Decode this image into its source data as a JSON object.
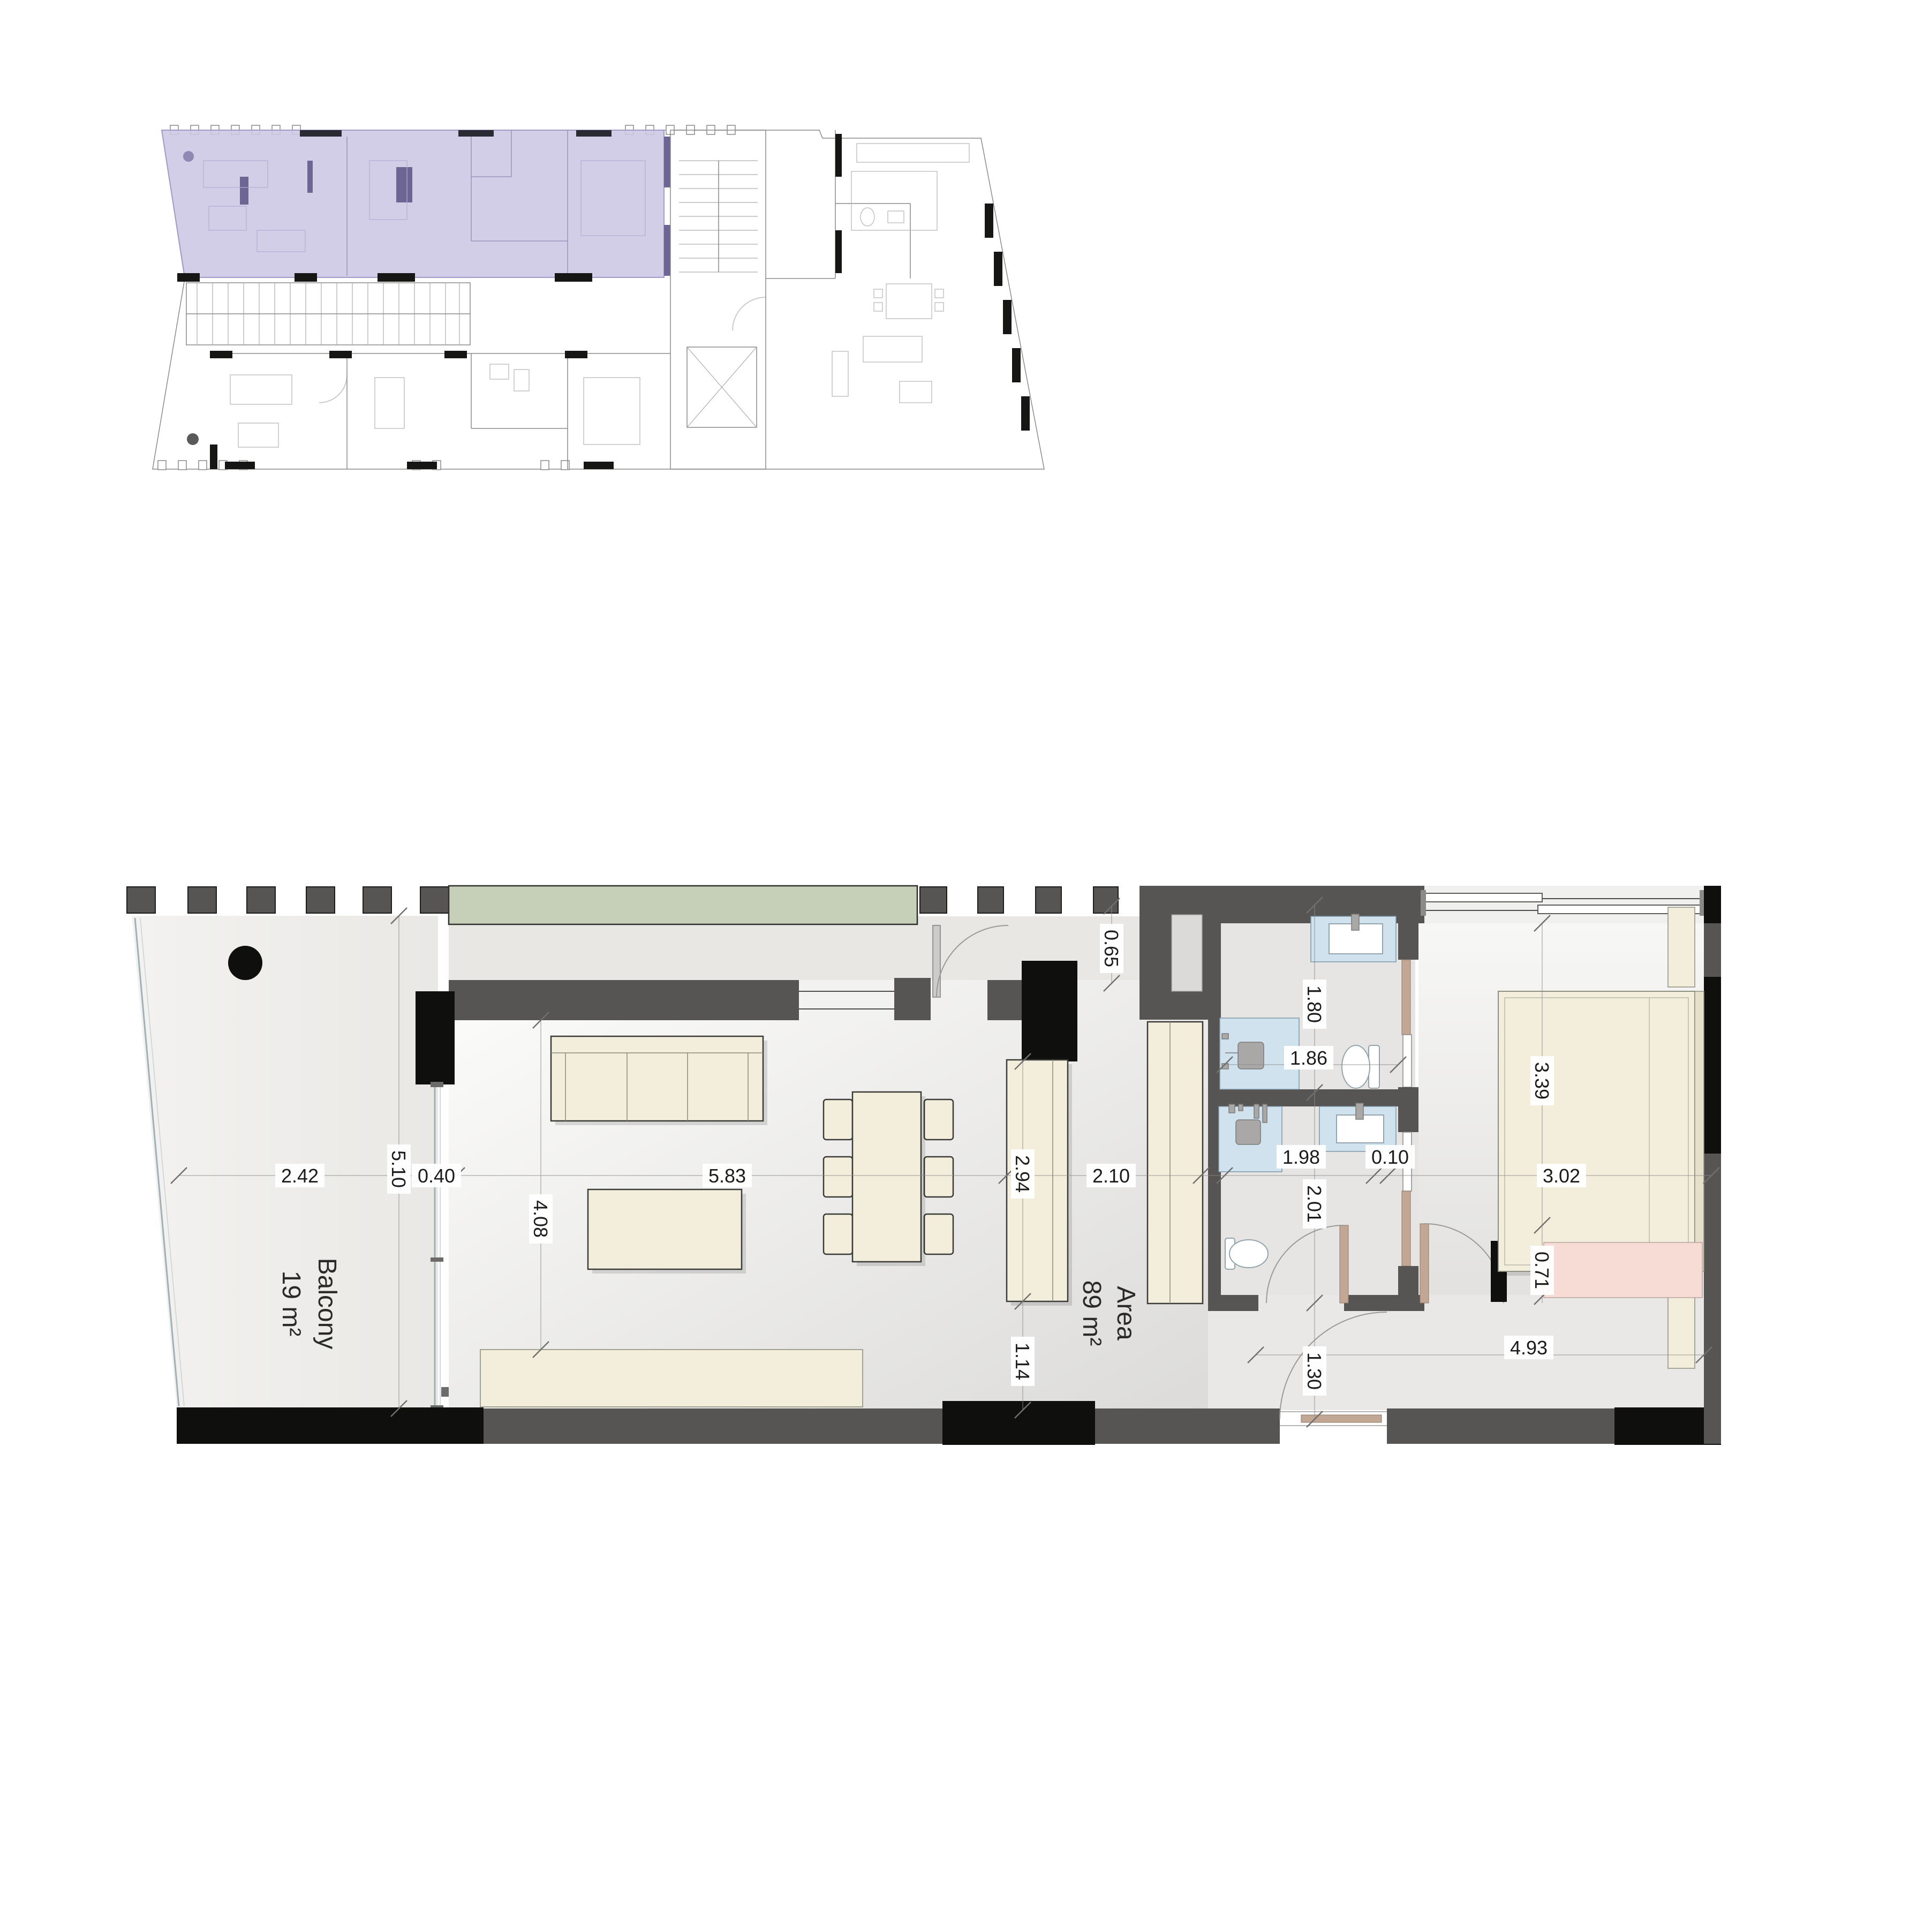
{
  "colors": {
    "accent_purple": "#cdc7e4",
    "purple_wall": "#8f88b5",
    "wall_gray": "#565553",
    "wall_black": "#0f0f0e",
    "planter_green": "#c6cfb7",
    "furniture_cream": "#f3eedc",
    "bath_blue": "#cfe2ee",
    "dresser_pink": "#f6dcd5",
    "door_tan": "#c2a794",
    "floor_light": "#efeeec"
  },
  "labels": {
    "balcony_name": "Balcony",
    "balcony_area": "19 m²",
    "area_name": "Area",
    "area_value": "89 m²"
  },
  "dims": {
    "d242": "2.42",
    "d040": "0.40",
    "d583": "5.83",
    "d210": "2.10",
    "d186": "1.86",
    "d198": "1.98",
    "d010": "0.10",
    "d302": "3.02",
    "d493": "4.93",
    "d510": "5.10",
    "d408": "4.08",
    "d065": "0.65",
    "d294": "2.94",
    "d114": "1.14",
    "d180": "1.80",
    "d201": "2.01",
    "d130": "1.30",
    "d339": "3.39",
    "d071": "0.71"
  }
}
